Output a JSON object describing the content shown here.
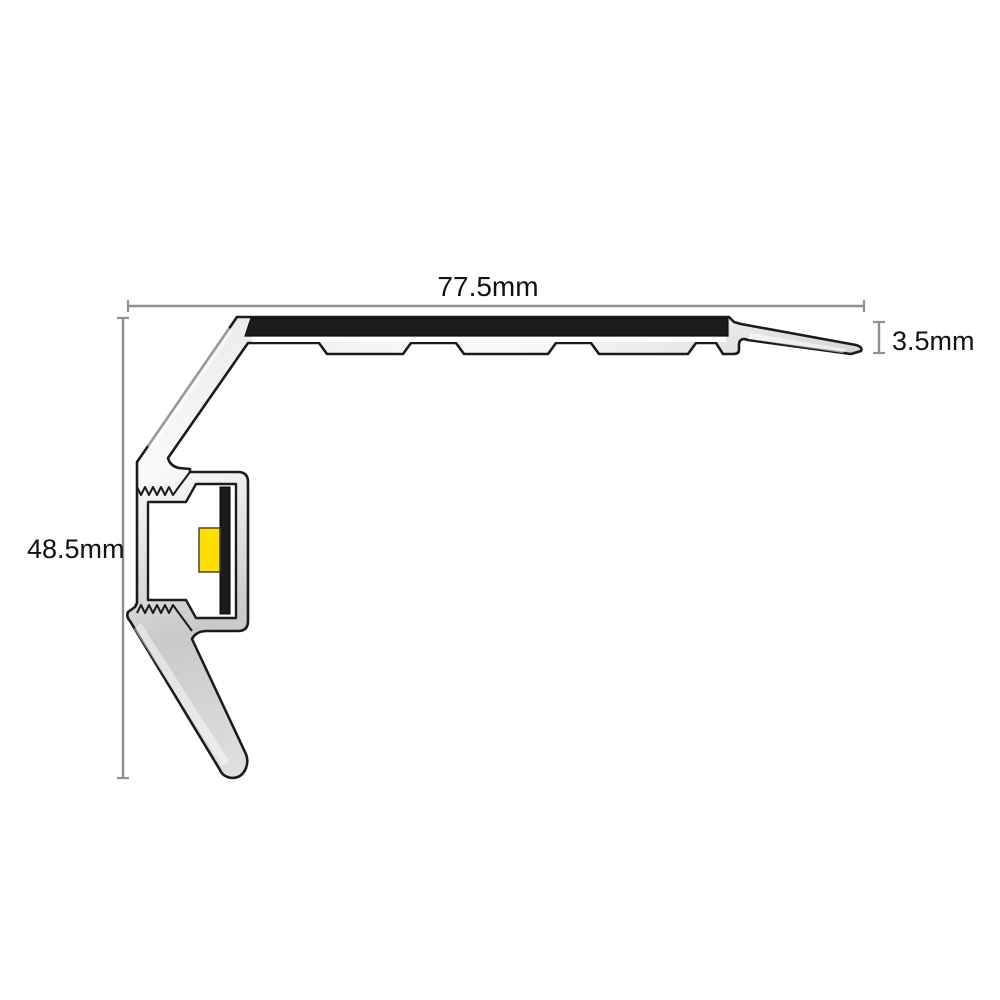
{
  "diagram": {
    "kind": "technical-cross-section",
    "dimensions": {
      "width": {
        "label": "77.5mm"
      },
      "height": {
        "label": "48.5mm"
      },
      "thickness": {
        "label": "3.5mm"
      }
    },
    "components": {
      "body": "aluminium-profile-body",
      "insert": "anti-slip-insert-strip",
      "channel": "led-channel-cavity",
      "pcb": "led-pcb-strip",
      "led": "led-module"
    },
    "colors": {
      "outline": "#1b1b1b",
      "alu_light": "#fafafa",
      "alu_mid": "#e6e6e6",
      "alu_dark": "#c9c9c9",
      "insert_black": "#1c1c1e",
      "led_yellow": "#ffdf00",
      "dim_gray": "#8f8f8f",
      "text_color": "#111111",
      "bg": "#ffffff"
    }
  }
}
